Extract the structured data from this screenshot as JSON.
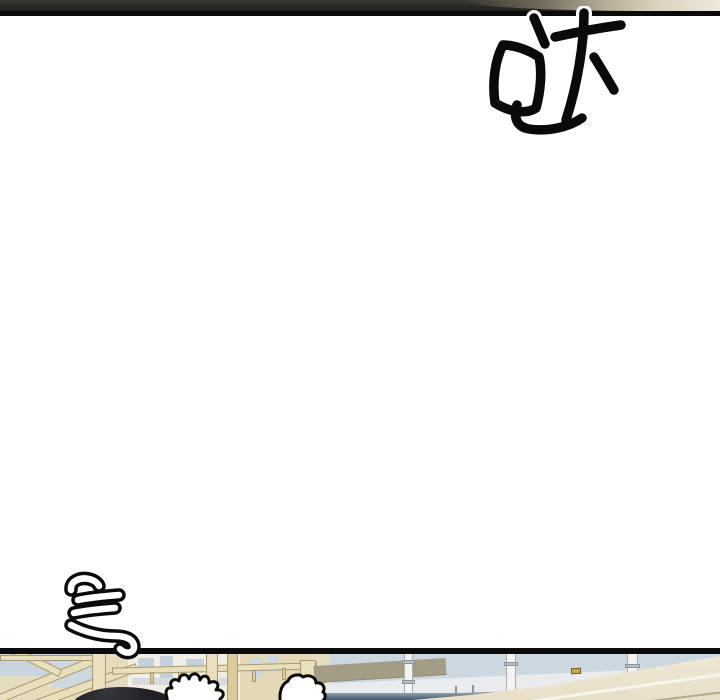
{
  "page": {
    "kind": "webtoon page fragment",
    "background_color": "#ffffff",
    "gutter": "large blank white space between two partially visible panels"
  },
  "sfx": [
    {
      "id": "sfx-top-right",
      "character": "哒",
      "style": "large solid-black handwritten strokes with white casing where they cross the panel border",
      "position": "top right, below the upper panel border"
    },
    {
      "id": "sfx-bottom-left",
      "character": "气",
      "style": "hand-drawn white strokes with thick black outline",
      "position": "bottom left, hook overlapping the lower panel border"
    }
  ],
  "panels": [
    {
      "id": "panel-top-sliver",
      "description": "bottom sliver of the previous panel: dark interior with a cream cloth highlight sweeping to the top-right corner",
      "border_color": "#0a0a0a",
      "base_color": "#2b2926",
      "highlight_color": "#eee9da"
    },
    {
      "id": "panel-bottom-sliver",
      "description": "top sliver of the next panel: building interior with beige scaffolding on the left, a blue-gray glass curtain wall with white mullions, an olive signboard band, and a cream ramp rising to the right; a dark-haired head, a spread hand and a closed fist rise from the bottom edge",
      "border_color": "#0b0b0b",
      "colors": {
        "scaffold_beige": "#e8dfbd",
        "scaffold_edge": "#a89a6e",
        "glass_blue": "#ccd7df",
        "wall_white": "#e9ebed",
        "band_olive": "#a49d86",
        "ramp_cream": "#ece4d0",
        "hair_dark": "#222226",
        "shadow_navy": "#42556b",
        "latch_gold": "#c9a94d"
      }
    }
  ]
}
